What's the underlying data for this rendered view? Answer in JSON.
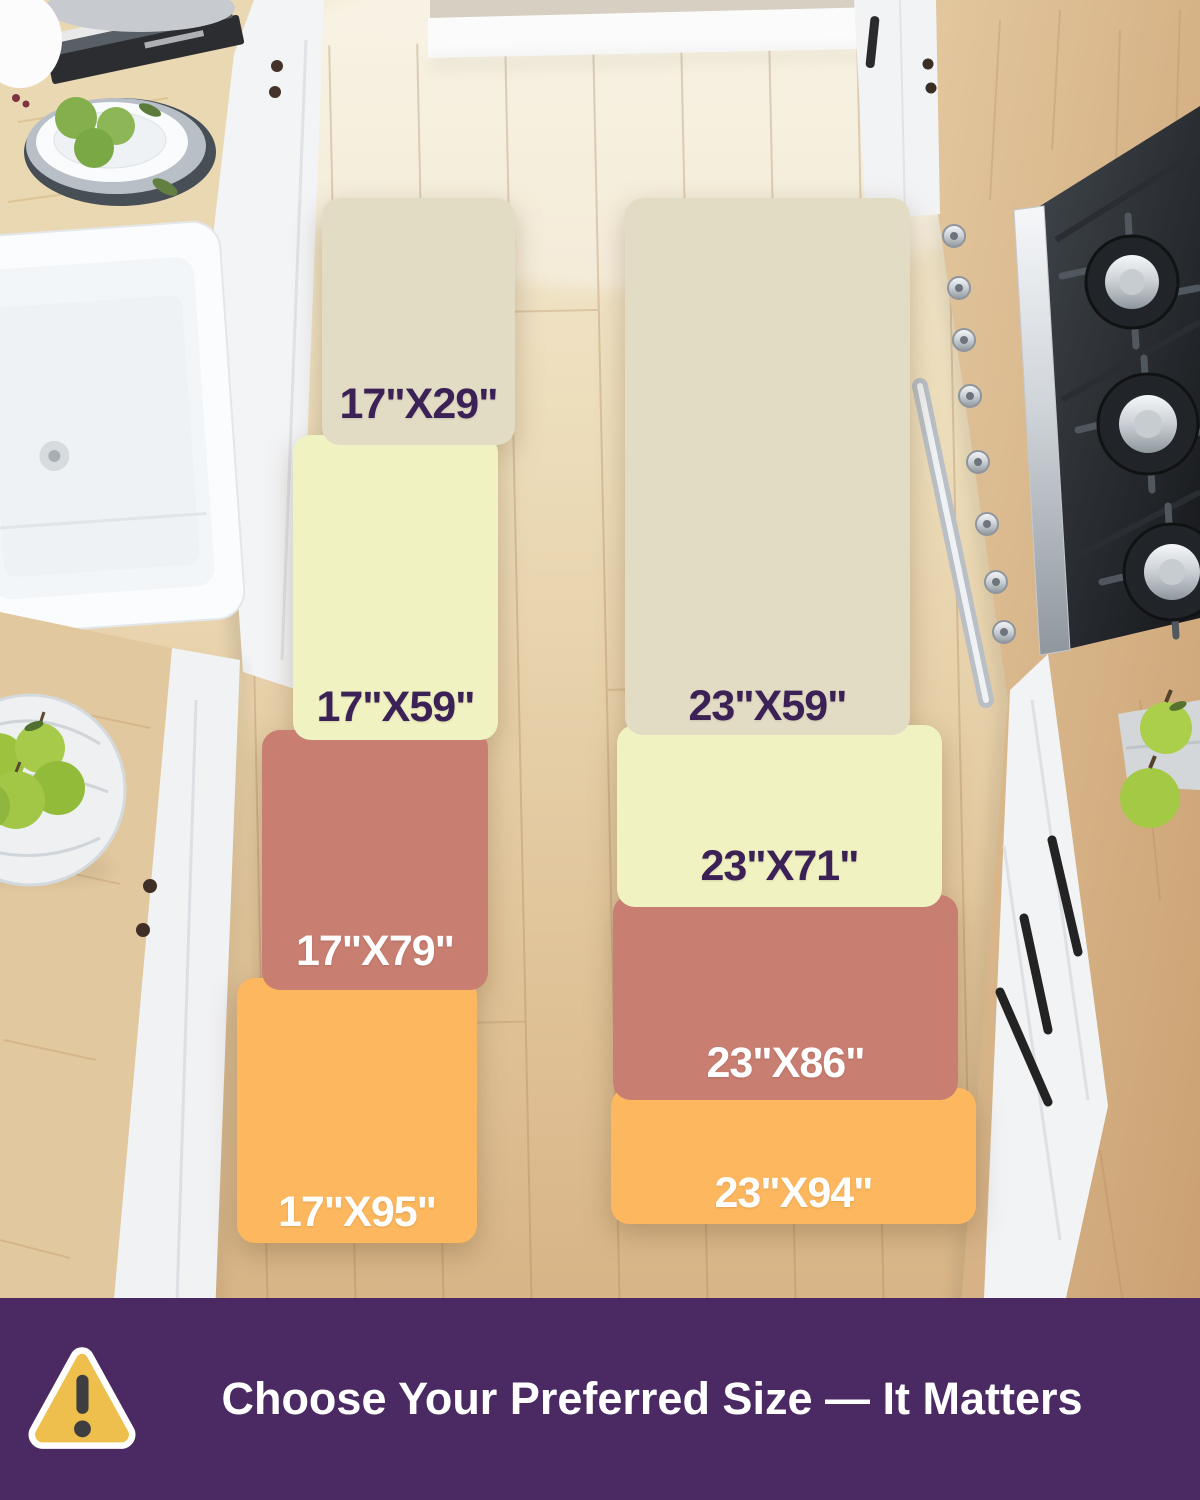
{
  "mats": {
    "left": {
      "name": "17-inch runner set",
      "segments": [
        {
          "label": "17\"X29\"",
          "color": "#e3dcc5",
          "label_color": "#3b2156"
        },
        {
          "label": "17\"X59\"",
          "color": "#f0f2c2",
          "label_color": "#3b2156"
        },
        {
          "label": "17\"X79\"",
          "color": "#c87e71",
          "label_color": "#ffffff"
        },
        {
          "label": "17\"X95\"",
          "color": "#fdb75e",
          "label_color": "#ffffff"
        }
      ]
    },
    "right": {
      "name": "23-inch runner set",
      "segments": [
        {
          "label": "23\"X59\"",
          "color": "#e3dcc5",
          "label_color": "#3b2156"
        },
        {
          "label": "23\"X71\"",
          "color": "#f0f2c2",
          "label_color": "#3b2156"
        },
        {
          "label": "23\"X86\"",
          "color": "#c87e71",
          "label_color": "#ffffff"
        },
        {
          "label": "23\"X94\"",
          "color": "#fdb75e",
          "label_color": "#ffffff"
        }
      ]
    }
  },
  "banner": {
    "text": "Choose Your Preferred Size — It Matters",
    "background_color": "#4b2a63",
    "text_color": "#ffffff",
    "icon": {
      "name": "warning-triangle-icon",
      "fill_color": "#efbf4d",
      "border_color": "#ffffff",
      "mark_color": "#3e3e40"
    }
  }
}
